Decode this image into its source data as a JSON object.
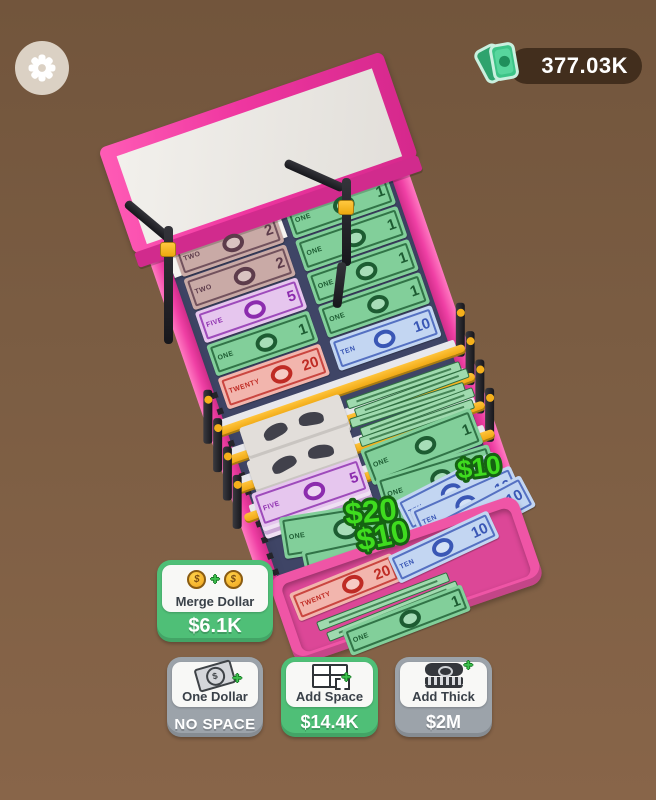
{
  "hud": {
    "settings_icon": "gear",
    "balance_icon": "cash",
    "balance": "377.03K"
  },
  "machine": {
    "belt_bills": [
      {
        "value": "2",
        "word": "TWO",
        "color": "brown"
      },
      {
        "value": "1",
        "word": "ONE",
        "color": "green"
      },
      {
        "value": "2",
        "word": "TWO",
        "color": "brown"
      },
      {
        "value": "1",
        "word": "ONE",
        "color": "green"
      },
      {
        "value": "5",
        "word": "FIVE",
        "color": "purple"
      },
      {
        "value": "1",
        "word": "ONE",
        "color": "green"
      },
      {
        "value": "1",
        "word": "ONE",
        "color": "green"
      },
      {
        "value": "1",
        "word": "ONE",
        "color": "green"
      },
      {
        "value": "20",
        "word": "TWENTY",
        "color": "red"
      },
      {
        "value": "10",
        "word": "TEN",
        "color": "blue"
      }
    ],
    "stacks": [
      {
        "color": "gray"
      },
      {
        "color": "gray"
      },
      {
        "color": "purple",
        "value": "5",
        "word": "FIVE"
      }
    ],
    "pile_bills": [
      {
        "value": "1",
        "word": "ONE",
        "color": "green"
      },
      {
        "value": "1",
        "word": "ONE",
        "color": "green"
      },
      {
        "value": "1",
        "word": "ONE",
        "color": "green"
      },
      {
        "value": "1",
        "word": "ONE",
        "color": "green"
      },
      {
        "value": "1",
        "word": "ONE",
        "color": "green"
      },
      {
        "value": "1",
        "word": "ONE",
        "color": "green"
      },
      {
        "value": "1",
        "word": "ONE",
        "color": "green"
      },
      {
        "value": "1",
        "word": "ONE",
        "color": "green"
      },
      {
        "value": "1",
        "word": "ONE",
        "color": "green"
      },
      {
        "value": "10",
        "word": "TEN",
        "color": "blue"
      },
      {
        "value": "10",
        "word": "TEN",
        "color": "blue"
      },
      {
        "value": "10",
        "word": "TEN",
        "color": "blue"
      },
      {
        "value": "20",
        "word": "TWENTY",
        "color": "red"
      },
      {
        "value": "1",
        "word": "ONE",
        "color": "green"
      }
    ],
    "tray_bills": [
      {
        "value": "20",
        "word": "TWENTY",
        "color": "red"
      },
      {
        "value": "10",
        "word": "TEN",
        "color": "blue"
      },
      {
        "value": "1",
        "word": "ONE",
        "color": "green"
      },
      {
        "value": "1",
        "word": "ONE",
        "color": "green"
      },
      {
        "value": "1",
        "word": "ONE",
        "color": "green"
      }
    ],
    "floating_gains": [
      "$10",
      "$20",
      "$10"
    ]
  },
  "buttons": {
    "merge": {
      "label": "Merge Dollar",
      "price": "$6.1K",
      "coin_symbol": "$",
      "plus_symbol": "+"
    },
    "one_dollar": {
      "label": "One Dollar",
      "price": "NO SPACE",
      "bill_symbol": "$",
      "plus_symbol": "+"
    },
    "add_space": {
      "label": "Add Space",
      "price": "$14.4K",
      "plus_symbol": "+"
    },
    "add_thick": {
      "label": "Add Thick",
      "price": "$2M",
      "plus_symbol": "+"
    }
  },
  "colors": {
    "background": "#7a5c42",
    "machine_pink": "#ef3fa4",
    "belt_navy": "#3f4566",
    "bar_yellow": "#f2ae18",
    "button_green": "#4fbf77",
    "button_gray": "#9ca3aa",
    "gain_green": "#3fdc1f",
    "coin_gold": "#f4a72d"
  }
}
